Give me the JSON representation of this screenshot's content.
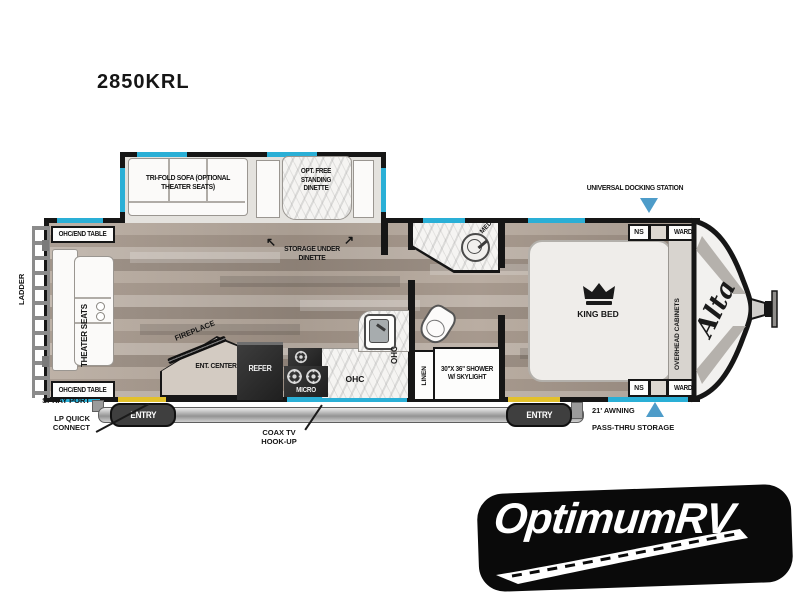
{
  "model": "2850KRL",
  "colors": {
    "wall": "#161616",
    "window_accent": "#2aafd6",
    "door_swing": "#e3c12b",
    "arrow_blue": "#4e9cc9",
    "floor_wood": "#ab9c8f",
    "appliance_dark": "#2d2d2d",
    "logo_bg": "#0a0a0a"
  },
  "exterior": {
    "ladder": "LADDER",
    "spray_port": "SPRAY PORT",
    "lp_quick_connect": "LP QUICK CONNECT",
    "coax_tv": "COAX TV HOOK-UP",
    "docking_station": "UNIVERSAL DOCKING STATION",
    "awning": "21' AWNING",
    "pass_thru": "PASS-THRU STORAGE",
    "entry_rear": "ENTRY",
    "entry_front": "ENTRY"
  },
  "living": {
    "ohc_end_table_top": "OHC/END TABLE",
    "ohc_end_table_bottom": "OHC/END TABLE",
    "theater_seats": "THEATER SEATS",
    "tri_fold_sofa": "TRI-FOLD SOFA (OPTIONAL THEATER SEATS)",
    "dinette": "OPT. FREE STANDING DINETTE",
    "storage_under_dinette": "STORAGE UNDER DINETTE",
    "fireplace": "FIREPLACE",
    "ent_center": "ENT. CENTER"
  },
  "kitchen": {
    "refer": "REFER",
    "micro": "MICRO",
    "ohc": "OHC",
    "ohc_side": "OHC"
  },
  "bath": {
    "med": "MED",
    "linen": "LINEN",
    "shower": "30\"X 36\" SHOWER W/ SKYLIGHT"
  },
  "bedroom": {
    "king_bed": "KING BED",
    "overhead_cabinets": "OVERHEAD CABINETS",
    "ns_top": "NS",
    "ns_bottom": "NS",
    "ward_top": "WARD",
    "ward_bottom": "WARD",
    "brand_script": "Alta"
  },
  "dealer_logo": "OptimumRV"
}
